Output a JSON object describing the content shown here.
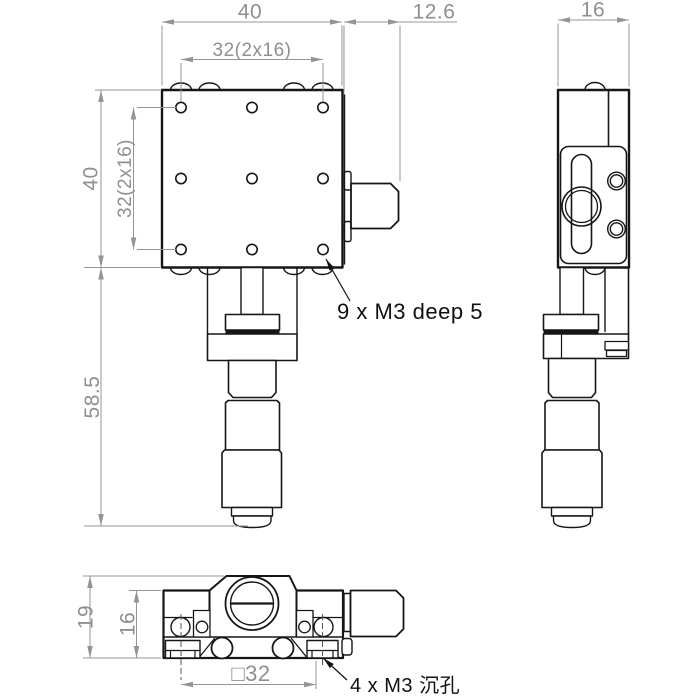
{
  "dimensions": {
    "front": {
      "width": "40",
      "hole_span_h": "32(2x16)",
      "height": "40",
      "hole_span_v": "32(2x16)",
      "overall_height": "58.5",
      "knob_length": "12.6"
    },
    "side": {
      "depth": "16"
    },
    "bottom": {
      "overall_height": "19",
      "body_height": "16",
      "mount_square": "□32"
    }
  },
  "annotations": {
    "top_thread": "9 x M3 deep 5",
    "bottom_thread": "4 x M3 沉孔"
  },
  "colors": {
    "object_line": "#161616",
    "dimension": "#8f8f8f",
    "background": "#ffffff"
  }
}
